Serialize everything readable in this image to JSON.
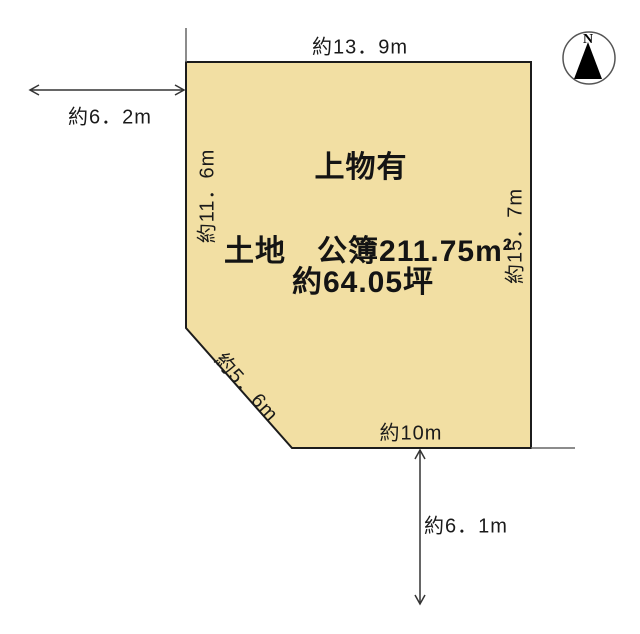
{
  "parcel": {
    "building_note": "上物有",
    "land_area_label": "土地　公簿211.75m",
    "land_area_sup": "2",
    "land_area_tsubo": "約64.05坪"
  },
  "dimensions": {
    "top_edge": "約13．9m",
    "left_edge": "約11．6m",
    "right_edge": "約15．7m",
    "diagonal_edge": "約5．6m",
    "bottom_edge": "約10m",
    "left_road_width": "約6．2m",
    "bottom_road_width": "約6．1m"
  },
  "compass": {
    "north_label": "N"
  },
  "colors": {
    "parcel_fill": "#F2DFA3",
    "parcel_stroke": "#1C1C1C",
    "guide_line": "#666666",
    "arrow": "#333333",
    "compass_ring": "#555555",
    "needle": "#000000"
  }
}
